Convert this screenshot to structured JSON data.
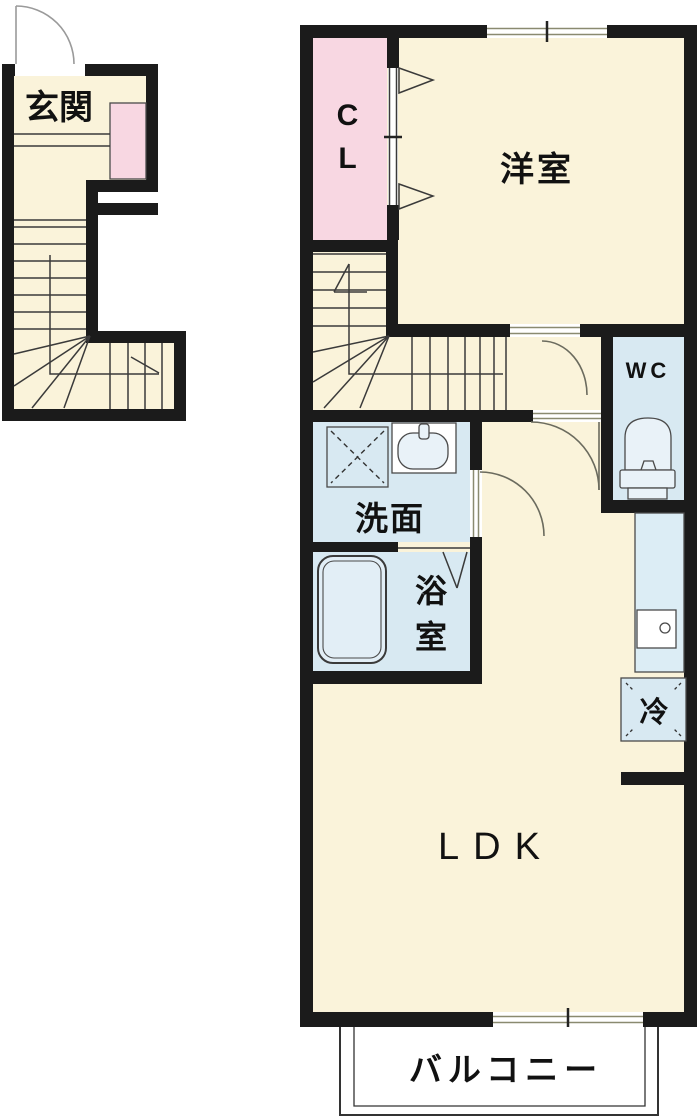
{
  "floorplan": {
    "labels": {
      "entrance": "玄関",
      "closet": "CL",
      "western_room": "洋室",
      "toilet": "WC",
      "washroom": "洗面",
      "bathroom": "浴室",
      "refrigerator": "冷",
      "living_dining_kitchen": "LDK",
      "balcony": "バルコニー"
    },
    "colors": {
      "wall": "#1b1b1b",
      "room_fill": "#faf3da",
      "wet_area_fill": "#d8e9f2",
      "closet_fill": "#f8d7e2",
      "fixture_line": "#3a3a3a",
      "frame_line": "#8a8a70",
      "text": "#111111",
      "background": "#ffffff"
    }
  }
}
